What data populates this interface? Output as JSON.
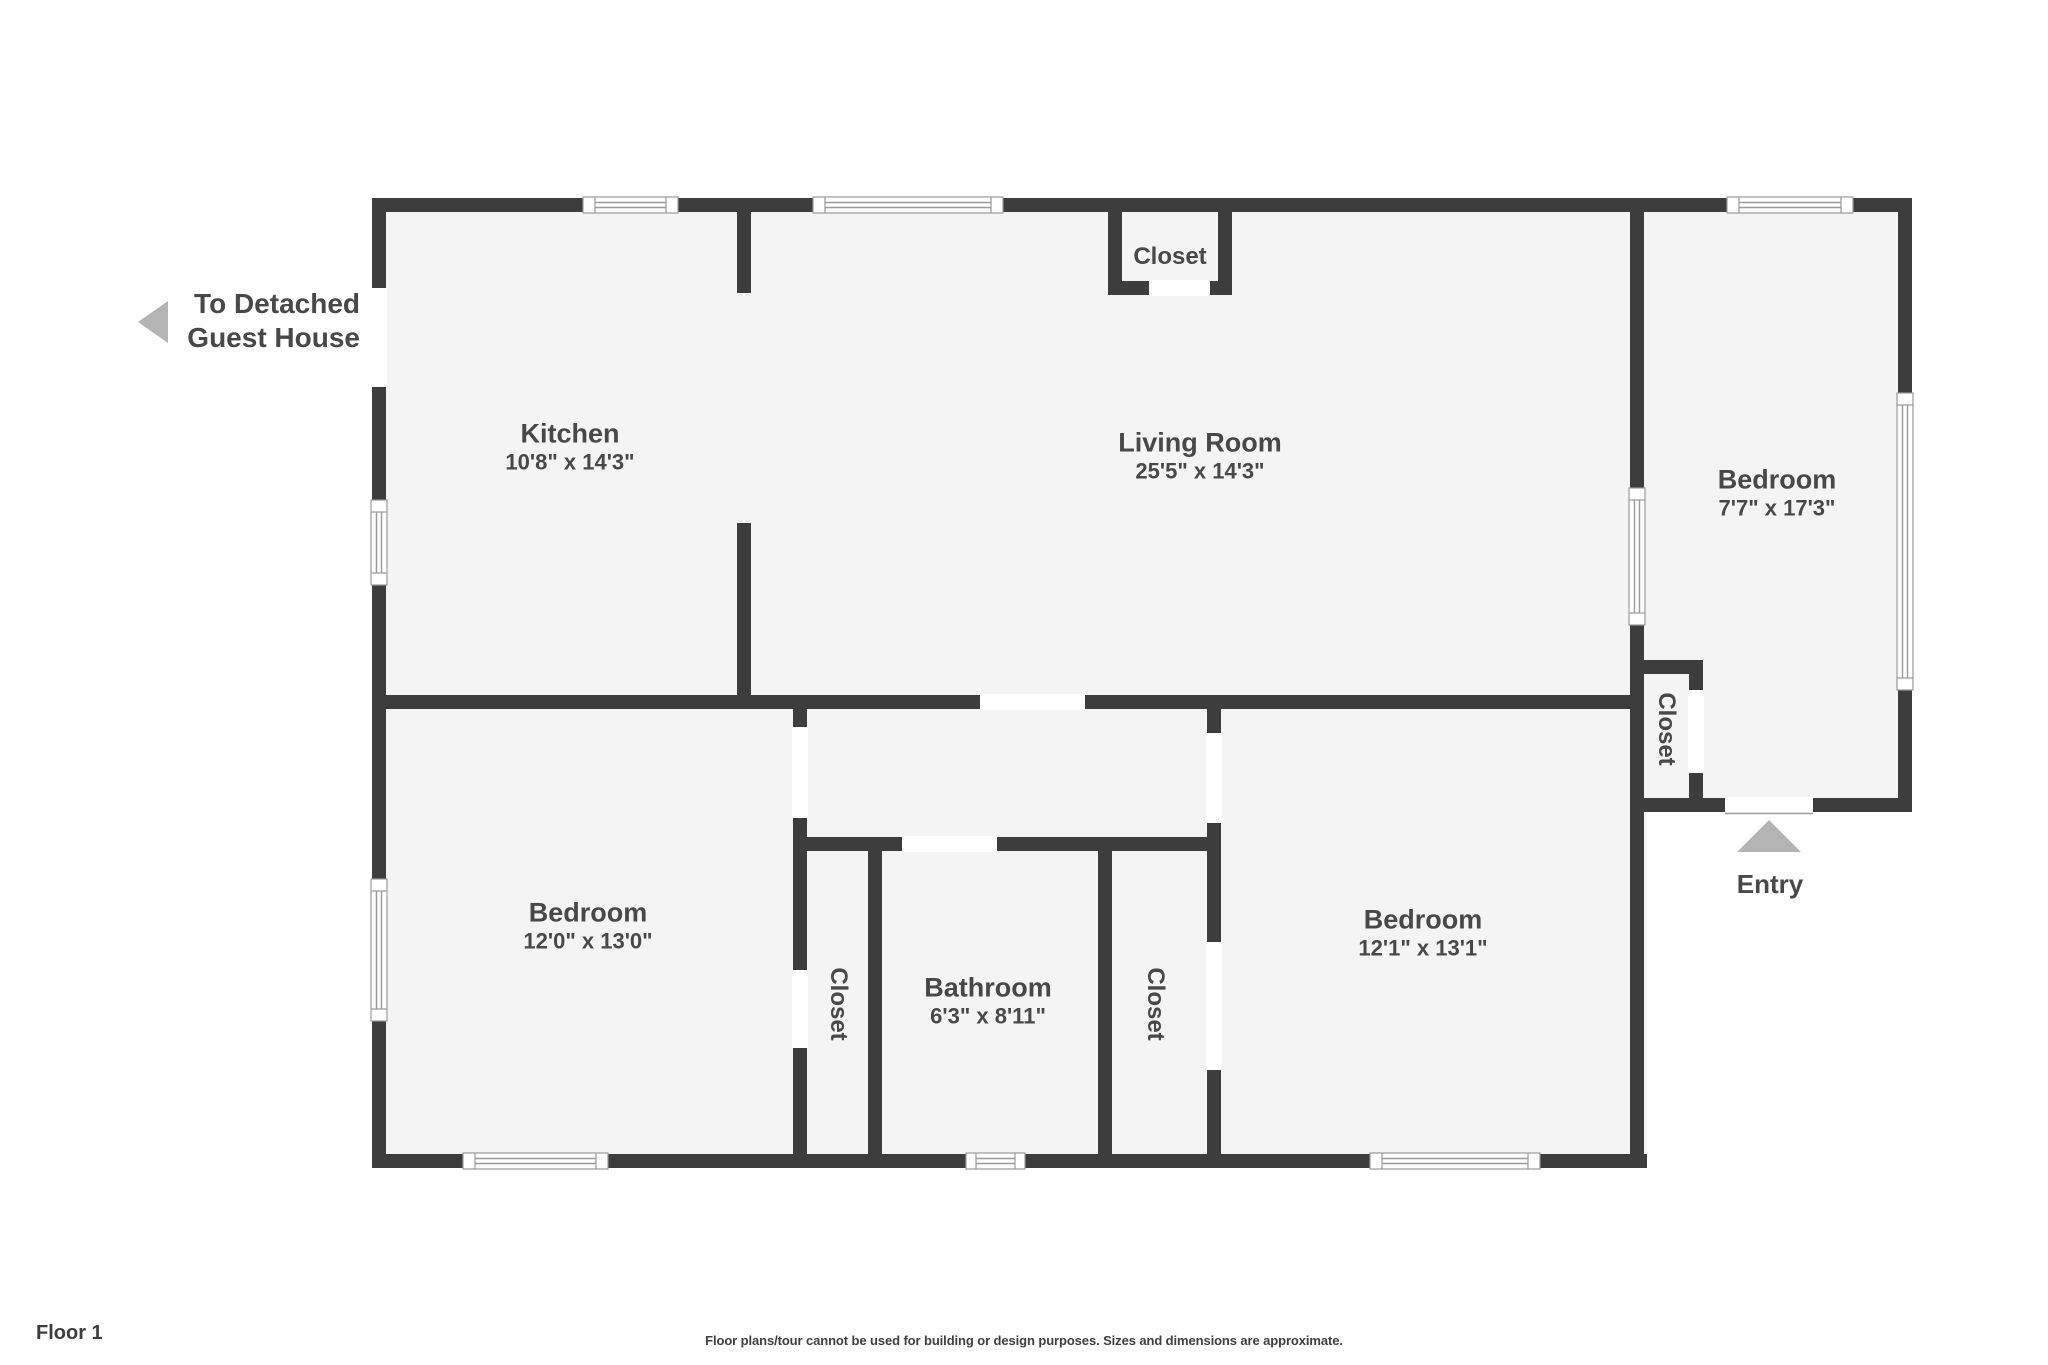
{
  "page": {
    "floor_label": "Floor 1",
    "disclaimer": "Floor plans/tour cannot be used for building or design purposes. Sizes and dimensions are approximate."
  },
  "annotations": {
    "guest_house_line1": "To Detached",
    "guest_house_line2": "Guest House",
    "entry_label": "Entry",
    "guest_arrow_icon": "triangle-left",
    "entry_arrow_icon": "triangle-up"
  },
  "rooms": {
    "kitchen": {
      "name": "Kitchen",
      "dims": "10'8\" x 14'3\""
    },
    "living_room": {
      "name": "Living Room",
      "dims": "25'5\" x 14'3\""
    },
    "bedroom_right_wing": {
      "name": "Bedroom",
      "dims": "7'7\" x 17'3\""
    },
    "bedroom_bottom_left": {
      "name": "Bedroom",
      "dims": "12'0\" x 13'0\""
    },
    "bedroom_bottom_right": {
      "name": "Bedroom",
      "dims": "12'1\" x 13'1\""
    },
    "bathroom": {
      "name": "Bathroom",
      "dims": "6'3\" x 8'11\""
    },
    "closet_top": {
      "name": "Closet"
    },
    "closet_entry_wing": {
      "name": "Closet"
    },
    "closet_hall_left": {
      "name": "Closet"
    },
    "closet_hall_right": {
      "name": "Closet"
    }
  },
  "colors": {
    "wall": "#3d3d3d",
    "floor": "#f4f4f4",
    "background": "#ffffff",
    "window_line": "#9a9a9a",
    "arrow": "#b4b4b4",
    "label_text": "#484848"
  }
}
